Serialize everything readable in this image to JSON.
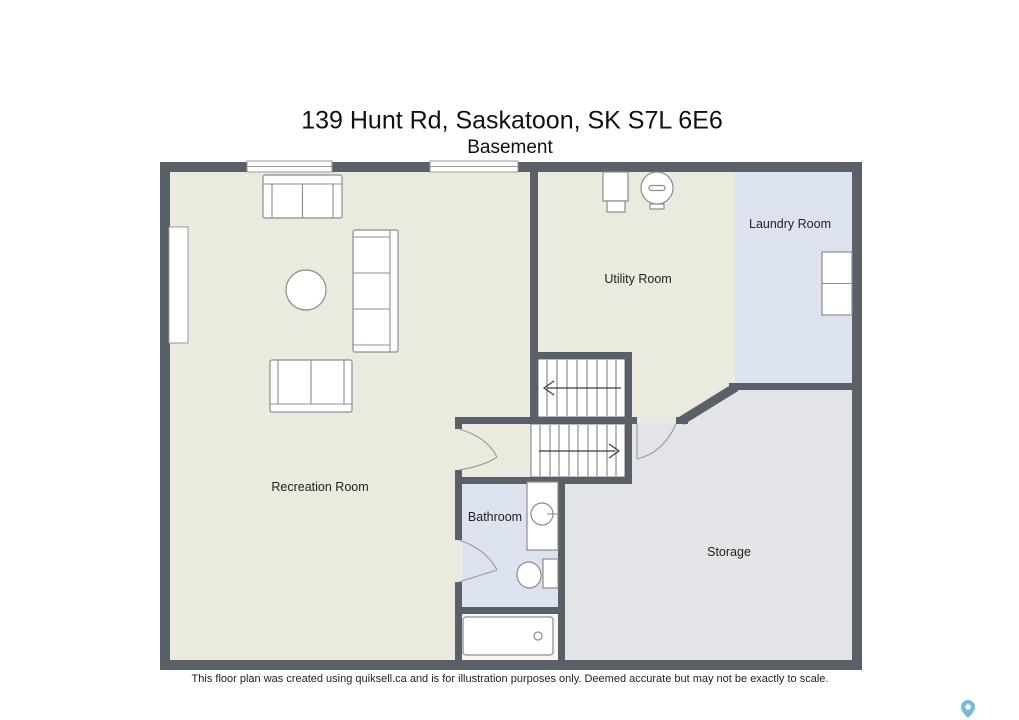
{
  "title": "139 Hunt Rd, Saskatoon, SK S7L 6E6",
  "subtitle": "Basement",
  "rooms": {
    "recreation": {
      "label": "Recreation Room"
    },
    "utility": {
      "label": "Utility Room"
    },
    "laundry": {
      "label": "Laundry Room"
    },
    "bathroom": {
      "label": "Bathroom"
    },
    "storage": {
      "label": "Storage"
    }
  },
  "stairs": {
    "upper_arrow_direction": "left",
    "lower_arrow_direction": "right"
  },
  "furniture_icons": {
    "sofa_top": "loveseat",
    "coffee_table": "round-table",
    "sofa_right": "three-seat-sofa",
    "sofa_bottom": "loveseat",
    "furnace": "furnace",
    "water_heater": "water-heater",
    "washer_dryer": "washer-dryer-stack",
    "vanity": "vanity-with-sink",
    "toilet": "toilet",
    "bathtub": "bathtub",
    "map_pin": "map-pin"
  },
  "disclaimer": "This floor plan was created using quiksell.ca and is for illustration purposes only. Deemed accurate but may not be exactly to scale.",
  "colors": {
    "wall": "#5a6067",
    "floor_main": "#eaeadf",
    "floor_blue": "#dce3ef",
    "floor_storage": "#e3e4e7",
    "floor_alcove": "#f7f7f3",
    "pin_blue": "#74bcdc"
  }
}
